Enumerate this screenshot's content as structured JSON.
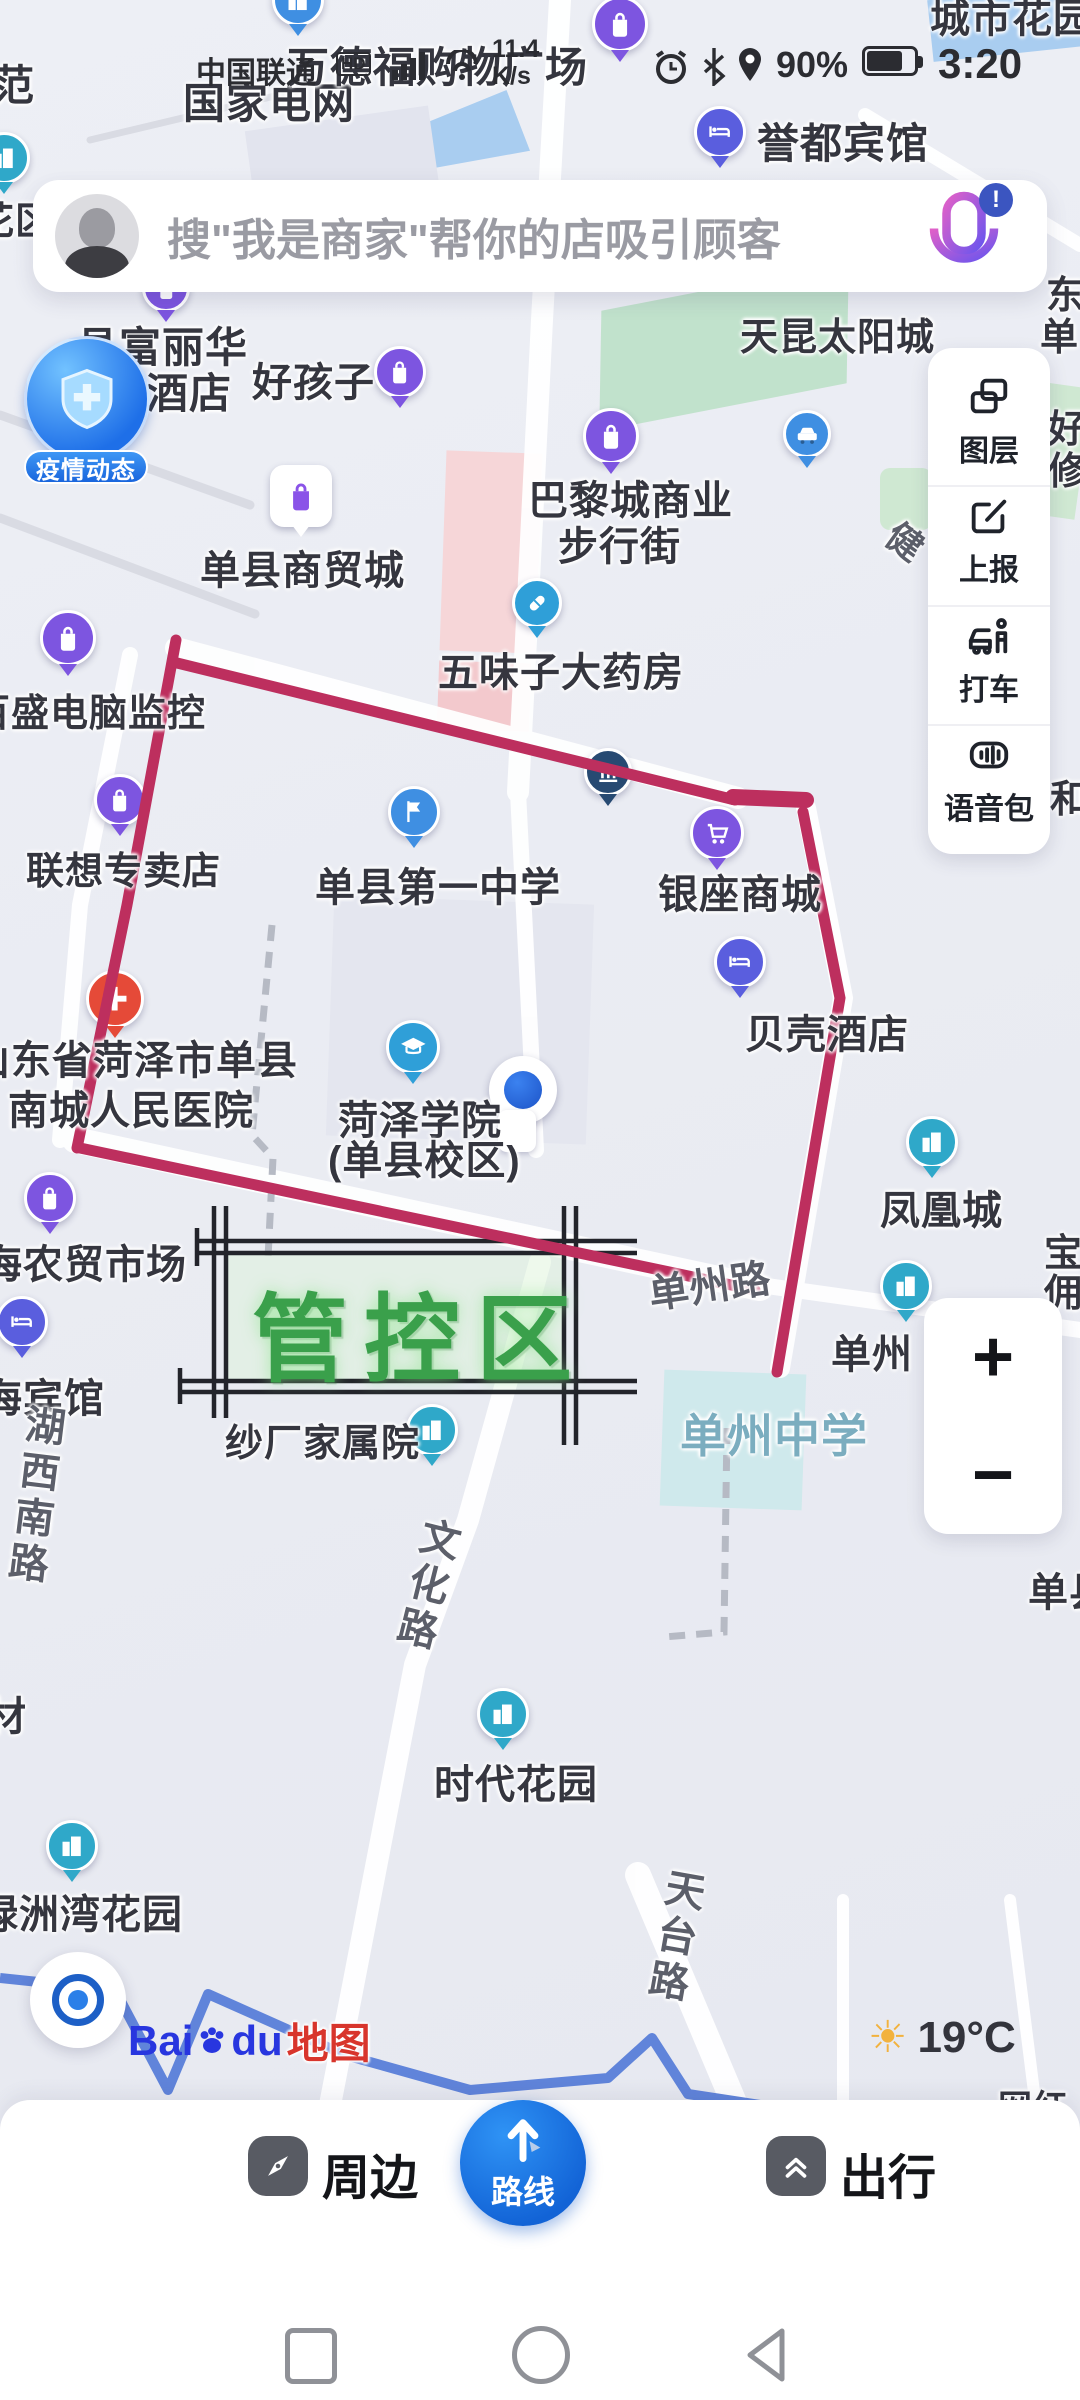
{
  "status_bar": {
    "carrier": "中国联通",
    "hd": "HD",
    "net_speed_value": "11.4",
    "net_speed_unit": "K/s",
    "battery_percent": "90%",
    "time": "3:20",
    "icons": [
      "signal-bars-icon",
      "wifi-icon",
      "alarm-icon",
      "bluetooth-icon",
      "location-icon",
      "battery-icon"
    ]
  },
  "search_bar": {
    "placeholder": "搜\"我是商家\"帮你的店吸引顾客",
    "avatar_icon": "user-avatar",
    "mic_icon": "microphone-icon",
    "mic_badge": "!"
  },
  "side_panel": {
    "items": {
      "layers": {
        "label": "图层",
        "icon": "layers-icon"
      },
      "report": {
        "label": "上报",
        "icon": "report-edit-icon"
      },
      "taxi": {
        "label": "打车",
        "icon": "taxi-icon"
      },
      "voice": {
        "label": "语音包",
        "icon": "voice-pack-icon"
      }
    }
  },
  "map": {
    "epidemic_badge": {
      "label": "疫情动态",
      "icon": "shield-cross-icon"
    },
    "control_zone": {
      "label": "管控区",
      "line_color": "#bd2f5e",
      "text_color": "#3aa04b",
      "frame_color": "#23242b"
    },
    "weather": {
      "temperature": "19°C",
      "icon": "sun-icon"
    },
    "logo": {
      "part1": "Bai",
      "part2": "du",
      "part3": "地图",
      "paw_icon": "baidu-paw-icon"
    },
    "pois": {
      "guojia": {
        "label": "国家电网"
      },
      "wandefu": {
        "label": "万德福购物广场"
      },
      "yudu": {
        "label": "誉都宾馆"
      },
      "fulihua": {
        "label1": "县富丽华",
        "label2": "酒店"
      },
      "haohaizi": {
        "label": "好孩子"
      },
      "tiankun": {
        "label": "天昆太阳城"
      },
      "balicheng": {
        "label1": "巴黎城商业",
        "label2": "步行街"
      },
      "shangmaocheng": {
        "label": "单县商贸城"
      },
      "wuweizi": {
        "label": "五味子大药房"
      },
      "baisheng": {
        "label": "百盛电脑监控"
      },
      "lianxiang": {
        "label": "联想专卖店"
      },
      "yizhong": {
        "label": "单县第一中学"
      },
      "yinzuo": {
        "label": "银座商城"
      },
      "beike": {
        "label": "贝壳酒店"
      },
      "fenghuang": {
        "label": "凤凰城"
      },
      "hospital": {
        "label1": "山东省菏泽市单县",
        "label2": "南城人民医院"
      },
      "xueyuan": {
        "label1": "菏泽学院",
        "label2": "(单县校区)"
      },
      "hainongmao": {
        "label": "海农贸市场"
      },
      "haibinguan": {
        "label": "海宾馆"
      },
      "shachang": {
        "label": "纱厂家属院"
      },
      "danzhou": {
        "label": "单州"
      },
      "danzhongxue": {
        "label": "单州中学"
      },
      "shidai": {
        "label": "时代花园"
      },
      "lvzhouwan": {
        "label": "绿洲湾花园"
      }
    },
    "road_labels": {
      "danzhoulu": "单州路",
      "wenhualu": "文化路",
      "tiantailu": "天台路",
      "huxinanlu": "湖西南路"
    },
    "partial_labels": {
      "fan": "范",
      "huaqu": "花区",
      "chengshihuayuan": "城市花园",
      "cai": "材",
      "dong": "东",
      "dan": "单",
      "hao": "好",
      "xiu": "修",
      "he": "和",
      "bao": "宝",
      "yong": "佣",
      "jian": "健",
      "wanghong": "网红",
      "danxian": "单县"
    }
  },
  "zoom_controls": {
    "zoom_in": "+",
    "zoom_out": "−"
  },
  "bottom_bar": {
    "items": {
      "nearby": {
        "label": "周边",
        "icon": "compass-icon"
      },
      "route": {
        "label": "路线",
        "icon": "route-arrow-icon"
      },
      "travel": {
        "label": "出行",
        "icon": "double-chevron-up-icon"
      }
    }
  },
  "nav_bar": {
    "recents_icon": "square",
    "home_icon": "circle",
    "back_icon": "triangle-left"
  }
}
